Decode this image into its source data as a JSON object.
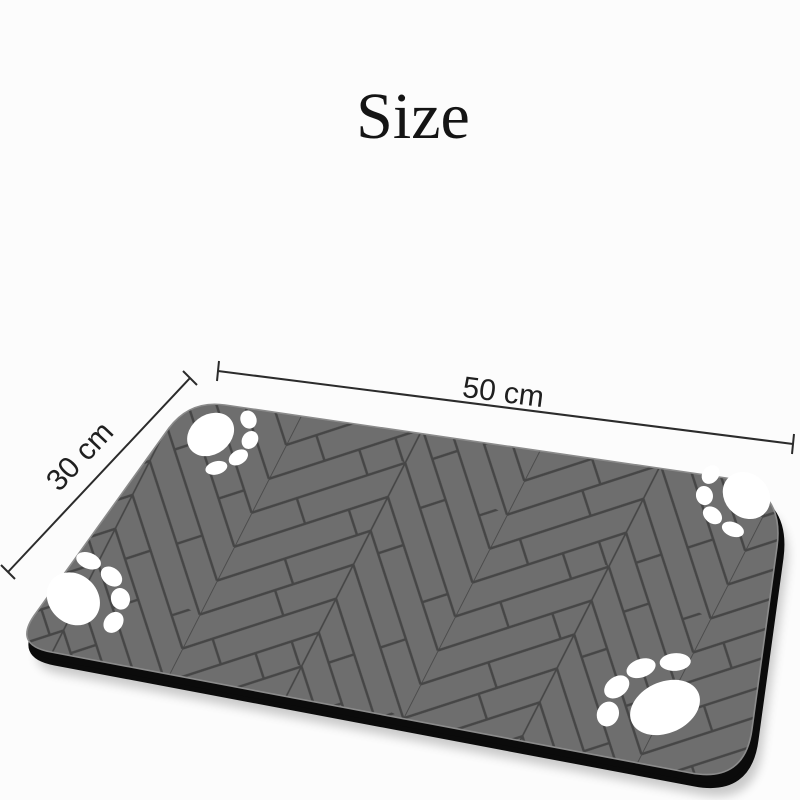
{
  "title": "Size",
  "diagram": {
    "kind": "product-size-diagram",
    "subject": "pet mat with herringbone plank pattern and four paw prints",
    "width_label": "50 cm",
    "depth_label": "30 cm",
    "paw_print_count": 4,
    "pattern_name": "herringbone"
  },
  "colors": {
    "background": "#fcfcfc",
    "title_text": "#141414",
    "dimension_line": "#2b2b2b",
    "mat_surface": "#6e6e6e",
    "plank_line": "#464646",
    "mat_edge": "#0b0b0b",
    "paw": "#ffffff"
  }
}
